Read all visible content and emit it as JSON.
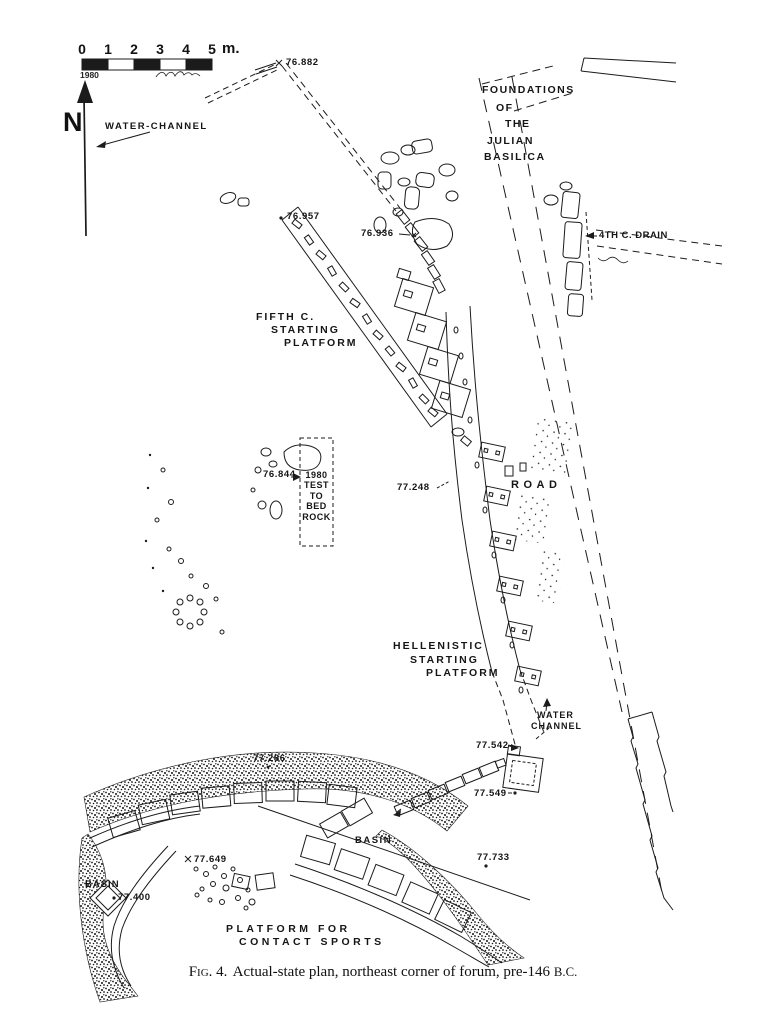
{
  "page": {
    "paper_color": "#ffffff",
    "ink_color": "#1b1b1b"
  },
  "scale_bar": {
    "ticks": [
      "0",
      "1",
      "2",
      "3",
      "4",
      "5"
    ],
    "unit": "m.",
    "year": "1980"
  },
  "compass": {
    "north_label": "N"
  },
  "labels": {
    "water_channel_nw": "WATER-CHANNEL",
    "foundations_lines": [
      "FOUNDATIONS",
      "OF",
      "THE",
      "JULIAN",
      "BASILICA"
    ],
    "drain": "4TH C. DRAIN",
    "fifth_platform_lines": [
      "FIFTH C.",
      "STARTING",
      "PLATFORM"
    ],
    "test_trench_lines": [
      "1980",
      "TEST",
      "TO",
      "BED",
      "ROCK"
    ],
    "road": "ROAD",
    "hellenistic_platform_lines": [
      "HELLENISTIC",
      "STARTING",
      "PLATFORM"
    ],
    "water_channel_s_lines": [
      "WATER",
      "CHANNEL"
    ],
    "basin_mid": "BASIN",
    "basin_sw": "BASIN",
    "sports_platform_lines": [
      "PLATFORM FOR",
      "CONTACT SPORTS"
    ]
  },
  "elevations": {
    "e76_882": "76.882",
    "e76_957": "76.957",
    "e76_936": "76.936",
    "e76_844": "76.844",
    "e77_248": "77.248",
    "e77_542": "77.542",
    "e77_549": "77.549",
    "e77_286": "77.286",
    "e77_649": "77.649",
    "e77_400": "77.400",
    "e77_733": "77.733"
  },
  "caption": {
    "figure_label": "Fig. 4.",
    "body": "Actual-state plan, northeast corner of forum, pre-146",
    "era": "B.C."
  }
}
